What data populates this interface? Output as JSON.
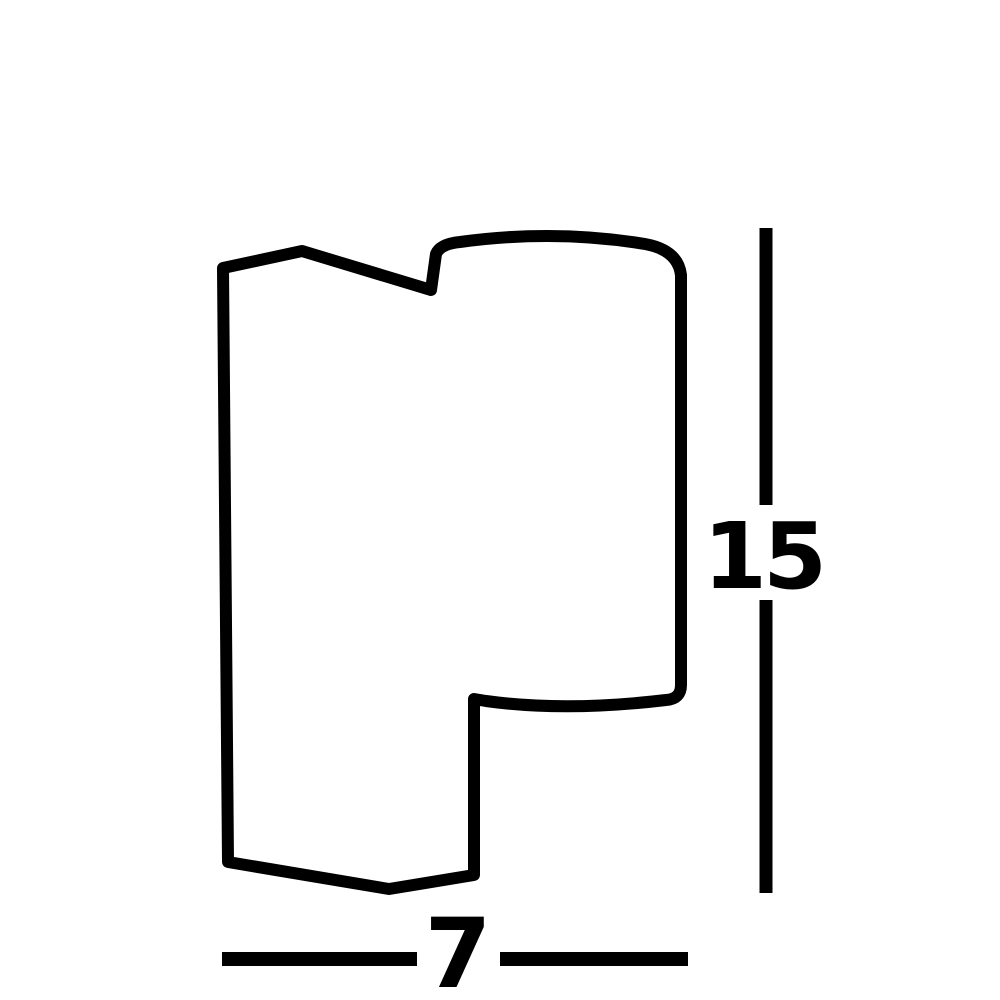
{
  "diagram": {
    "type": "product-dimension-drawing",
    "background_color": "#ffffff",
    "line_color": "#000000",
    "height_dimension": {
      "value": "15",
      "orientation": "vertical",
      "position": "right-of-shape"
    },
    "width_dimension": {
      "value": "7",
      "orientation": "horizontal",
      "position": "below-shape"
    },
    "shape": {
      "description": "wall-light profile silhouette outline",
      "path": "M 228 862 L 223 268 L 302 251 L 431 290 L 436 254 Q 440 244 460 242 Q 555 229 645 244 Q 678 250 681 275 L 681 685 Q 681 699 666 700 Q 565 712 486 701 L 474 699 L 474 875 L 389 889 Z"
    }
  }
}
